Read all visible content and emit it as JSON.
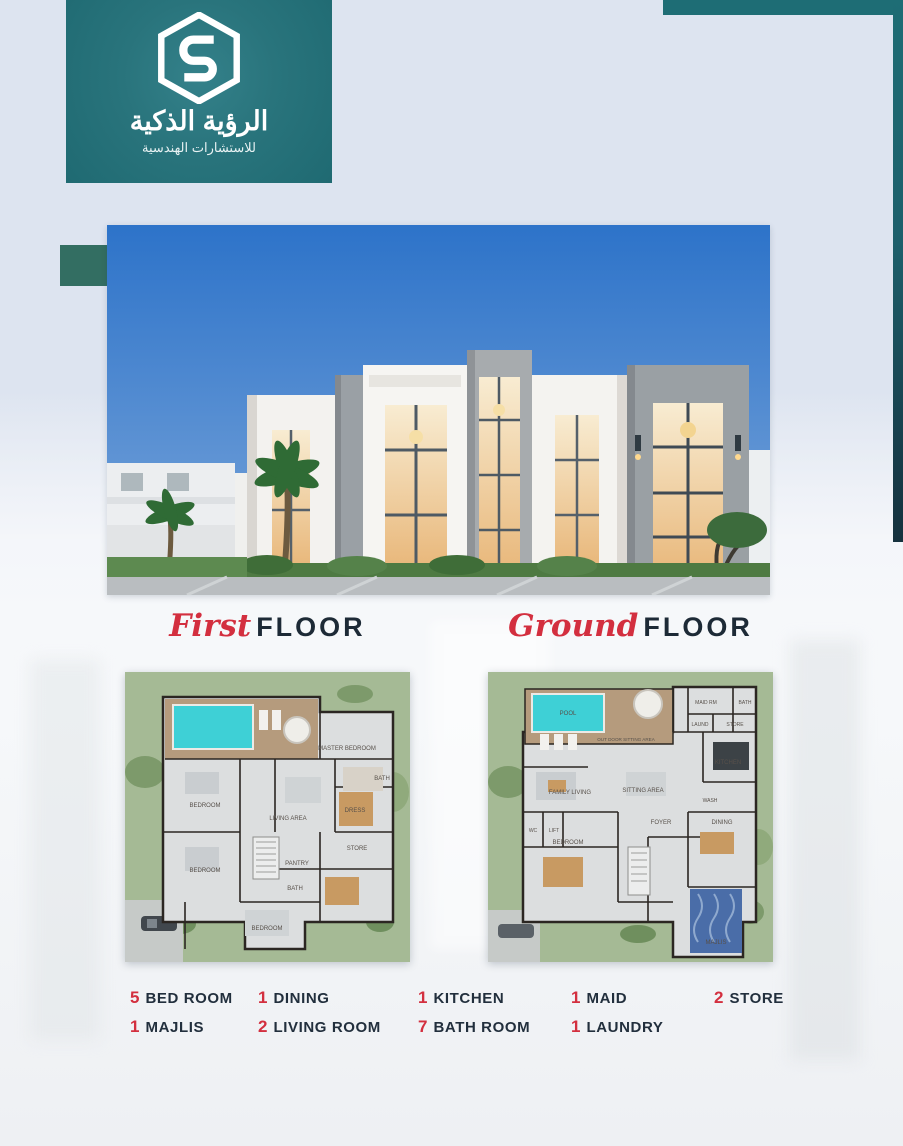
{
  "brand": {
    "logo_icon": "hexagon-s-monogram",
    "title_ar": "الرؤية الذكية",
    "subtitle_ar": "للاستشارات الهندسية",
    "panel_color": "#23707a"
  },
  "deco": {
    "teal_bar_color": "#1e6d75",
    "accent_rect_color": "#336e62"
  },
  "sections": {
    "first": {
      "script": "First",
      "word": "FLOOR"
    },
    "ground": {
      "script": "Ground",
      "word": "FLOOR"
    }
  },
  "plans": {
    "pool_color": "#3ed0d6",
    "first": {
      "rooms": [
        "MASTER BEDROOM",
        "BEDROOM",
        "LIVING AREA",
        "DRESS",
        "BATH",
        "STORE",
        "PANTRY",
        "BATH",
        "BEDROOM",
        "BEDROOM"
      ]
    },
    "ground": {
      "rooms": [
        "POOL",
        "OUT DOOR SITTING AREA",
        "MAID RM",
        "BATH",
        "LAUND",
        "STORE",
        "KITCHEN",
        "FAMILY LIVING",
        "SITTING AREA",
        "WC",
        "LIFT",
        "WASH",
        "BEDROOM",
        "FOYER",
        "DINING",
        "MAJLIS"
      ]
    }
  },
  "legend": {
    "count_color": "#d32f3f",
    "label_color": "#222f3d",
    "items": [
      {
        "count": "5",
        "label": "BED ROOM"
      },
      {
        "count": "1",
        "label": "DINING"
      },
      {
        "count": "1",
        "label": "KITCHEN"
      },
      {
        "count": "1",
        "label": "MAID"
      },
      {
        "count": "2",
        "label": "STORE"
      },
      {
        "count": "1",
        "label": "MAJLIS"
      },
      {
        "count": "2",
        "label": "LIVING ROOM"
      },
      {
        "count": "7",
        "label": "BATH ROOM"
      },
      {
        "count": "1",
        "label": "LAUNDRY"
      }
    ]
  }
}
